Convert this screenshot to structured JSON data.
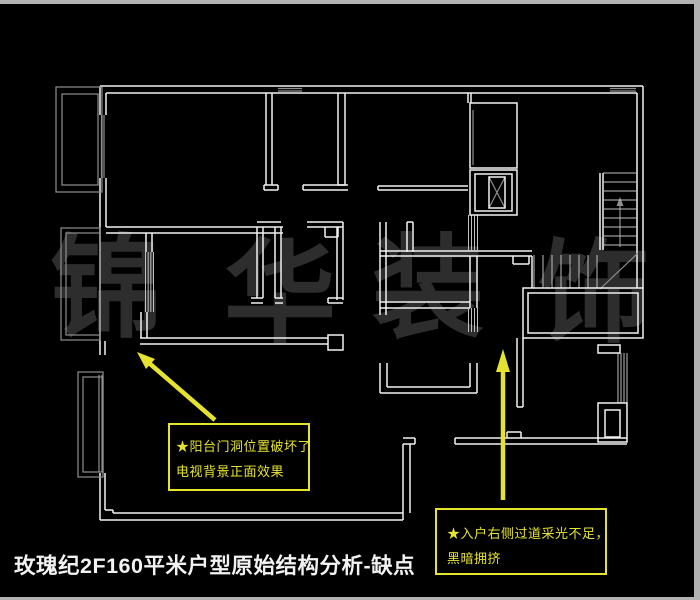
{
  "page": {
    "title": "玫瑰纪2F160平米户型原始结构分析-缺点"
  },
  "watermark": {
    "chars": [
      "锦",
      "华",
      "装",
      "饰"
    ],
    "color": "#2d2d2d",
    "positions": [
      {
        "x": 50,
        "y": 233
      },
      {
        "x": 224,
        "y": 238
      },
      {
        "x": 372,
        "y": 233
      },
      {
        "x": 538,
        "y": 238
      }
    ]
  },
  "annotations": {
    "balcony_door": {
      "line1": "★阳台门洞位置破坏了",
      "line2": "电视背景正面效果"
    },
    "entry_corridor": {
      "line1": "★入户右侧过道采光不足，",
      "line2": "黑暗拥挤"
    }
  },
  "colors": {
    "background": "#000000",
    "wall": "#f2f2f2",
    "light": "#8f8f8f",
    "hatch": "#c0c0c0",
    "accent": "#e6e330",
    "watermark": "#2d2d2d",
    "border": "#b2b2b2",
    "title": "#f2f2f2"
  },
  "plan": {
    "segments_white": [
      [
        100,
        86,
        643,
        86
      ],
      [
        106,
        93,
        637,
        93
      ],
      [
        643,
        86,
        643,
        288
      ],
      [
        637,
        93,
        637,
        288
      ],
      [
        100,
        86,
        100,
        115
      ],
      [
        106,
        93,
        106,
        115
      ],
      [
        100,
        178,
        100,
        355
      ],
      [
        106,
        178,
        106,
        227
      ],
      [
        105,
        341,
        105,
        355
      ],
      [
        106,
        227,
        283,
        227
      ],
      [
        106,
        233,
        283,
        233
      ],
      [
        146,
        233,
        146,
        252
      ],
      [
        152,
        233,
        152,
        252
      ],
      [
        141,
        312,
        141,
        338
      ],
      [
        147,
        312,
        147,
        338
      ],
      [
        140,
        338,
        328,
        338
      ],
      [
        140,
        344,
        328,
        344
      ],
      [
        257,
        227,
        257,
        298
      ],
      [
        263,
        227,
        263,
        298
      ],
      [
        275,
        227,
        275,
        298
      ],
      [
        281,
        227,
        281,
        298
      ],
      [
        257,
        222,
        281,
        222
      ],
      [
        251,
        298,
        263,
        298
      ],
      [
        251,
        303,
        263,
        303
      ],
      [
        275,
        298,
        283,
        298
      ],
      [
        275,
        303,
        283,
        303
      ],
      [
        307,
        222,
        343,
        222
      ],
      [
        307,
        227,
        343,
        227
      ],
      [
        325,
        227,
        325,
        237
      ],
      [
        338,
        227,
        338,
        237
      ],
      [
        325,
        237,
        338,
        237
      ],
      [
        337,
        227,
        337,
        300
      ],
      [
        343,
        222,
        343,
        300
      ],
      [
        328,
        298,
        343,
        298
      ],
      [
        328,
        303,
        343,
        303
      ],
      [
        328,
        298,
        328,
        303
      ],
      [
        266,
        93,
        266,
        185
      ],
      [
        272,
        93,
        272,
        185
      ],
      [
        264,
        185,
        278,
        185
      ],
      [
        264,
        190,
        278,
        190
      ],
      [
        264,
        185,
        264,
        190
      ],
      [
        278,
        185,
        278,
        190
      ],
      [
        303,
        185,
        348,
        185
      ],
      [
        303,
        190,
        348,
        190
      ],
      [
        303,
        185,
        303,
        190
      ],
      [
        338,
        93,
        338,
        185
      ],
      [
        345,
        93,
        345,
        185
      ],
      [
        338,
        185,
        345,
        185
      ],
      [
        378,
        186,
        468,
        186
      ],
      [
        378,
        190,
        468,
        190
      ],
      [
        378,
        186,
        378,
        190
      ],
      [
        380,
        222,
        380,
        315
      ],
      [
        386,
        222,
        386,
        315
      ],
      [
        407,
        222,
        413,
        222
      ],
      [
        407,
        222,
        407,
        252
      ],
      [
        413,
        222,
        413,
        252
      ],
      [
        380,
        302,
        470,
        302
      ],
      [
        380,
        308,
        470,
        308
      ],
      [
        380,
        251,
        532,
        251
      ],
      [
        380,
        256,
        532,
        256
      ],
      [
        513,
        256,
        513,
        264
      ],
      [
        529,
        256,
        529,
        264
      ],
      [
        513,
        264,
        529,
        264
      ],
      [
        380,
        363,
        380,
        393
      ],
      [
        387,
        363,
        387,
        387
      ],
      [
        380,
        393,
        477,
        393
      ],
      [
        387,
        387,
        470,
        387
      ],
      [
        470,
        363,
        470,
        387
      ],
      [
        477,
        363,
        477,
        393
      ],
      [
        468,
        93,
        468,
        103
      ],
      [
        471,
        93,
        471,
        103
      ],
      [
        470,
        256,
        470,
        308
      ],
      [
        477,
        256,
        477,
        308
      ],
      [
        517,
        338,
        517,
        407
      ],
      [
        523,
        338,
        523,
        407
      ],
      [
        517,
        407,
        523,
        407
      ],
      [
        403,
        438,
        415,
        438
      ],
      [
        403,
        444,
        415,
        444
      ],
      [
        415,
        438,
        415,
        444
      ],
      [
        455,
        438,
        627,
        438
      ],
      [
        455,
        444,
        627,
        444
      ],
      [
        455,
        438,
        455,
        444
      ],
      [
        507,
        432,
        521,
        432
      ],
      [
        507,
        432,
        507,
        438
      ],
      [
        521,
        432,
        521,
        438
      ],
      [
        100,
        520,
        403,
        520
      ],
      [
        113,
        513,
        403,
        513
      ],
      [
        100,
        473,
        100,
        520
      ],
      [
        105,
        473,
        105,
        510
      ],
      [
        105,
        510,
        113,
        510
      ],
      [
        113,
        510,
        113,
        513
      ],
      [
        403,
        444,
        403,
        520
      ],
      [
        410,
        444,
        410,
        513
      ],
      [
        600,
        173,
        600,
        250
      ],
      [
        603,
        173,
        603,
        250
      ],
      [
        532,
        256,
        532,
        288
      ]
    ],
    "segments_gray": [
      [
        278,
        88.5,
        302,
        88.5
      ],
      [
        278,
        91,
        302,
        91
      ],
      [
        610,
        88.5,
        636,
        88.5
      ],
      [
        610,
        91,
        636,
        91
      ],
      [
        101.5,
        115,
        101.5,
        178
      ],
      [
        104,
        115,
        104,
        178
      ],
      [
        473,
        110,
        473,
        165
      ],
      [
        489,
        177,
        505,
        208
      ],
      [
        505,
        177,
        489,
        208
      ],
      [
        99,
        375,
        99,
        472
      ],
      [
        102,
        375,
        102,
        472
      ],
      [
        600,
        289,
        638,
        253
      ],
      [
        620,
        202,
        620,
        247
      ]
    ],
    "rects_white": [
      [
        470,
        103,
        47,
        65
      ],
      [
        470,
        170,
        47,
        45
      ],
      [
        475,
        174,
        37,
        37
      ],
      [
        489,
        177,
        16,
        31
      ],
      [
        523,
        288,
        120,
        50
      ],
      [
        528,
        293,
        110,
        40
      ],
      [
        598,
        345,
        22,
        8
      ],
      [
        598,
        403,
        29,
        39
      ],
      [
        605,
        410,
        15,
        27
      ],
      [
        328,
        335,
        15,
        15
      ]
    ],
    "rects_gray": [
      [
        56,
        87,
        46,
        105
      ],
      [
        62,
        94,
        36,
        91
      ],
      [
        61,
        228,
        39,
        112
      ],
      [
        66,
        233,
        34,
        102
      ],
      [
        78,
        372,
        25,
        105
      ],
      [
        83,
        377,
        20,
        95
      ]
    ],
    "hatches": [
      {
        "dir": "v",
        "a1": 145.5,
        "a2": 153.5,
        "n": 4,
        "b1": 252,
        "b2": 312
      },
      {
        "dir": "v",
        "a1": 468.5,
        "a2": 477.5,
        "n": 4,
        "b1": 215,
        "b2": 250
      },
      {
        "dir": "v",
        "a1": 468.5,
        "a2": 477.5,
        "n": 4,
        "b1": 308,
        "b2": 332
      },
      {
        "dir": "v",
        "a1": 618,
        "a2": 627,
        "n": 4,
        "b1": 353,
        "b2": 403
      },
      {
        "dir": "h",
        "a1": 173,
        "a2": 245,
        "n": 9,
        "b1": 603,
        "b2": 637
      },
      {
        "dir": "v",
        "a1": 534,
        "a2": 597,
        "n": 8,
        "b1": 255,
        "b2": 288
      }
    ],
    "gray_polygons": [
      "620,197 616.5,206 623.5,206"
    ],
    "arrows": [
      {
        "shaft": [
          215,
          420,
          149,
          363
        ],
        "head": "137,352 155,359 146,369"
      },
      {
        "shaft": [
          503,
          500,
          503,
          372
        ],
        "head": "503,349 496,372 510,372"
      }
    ]
  }
}
